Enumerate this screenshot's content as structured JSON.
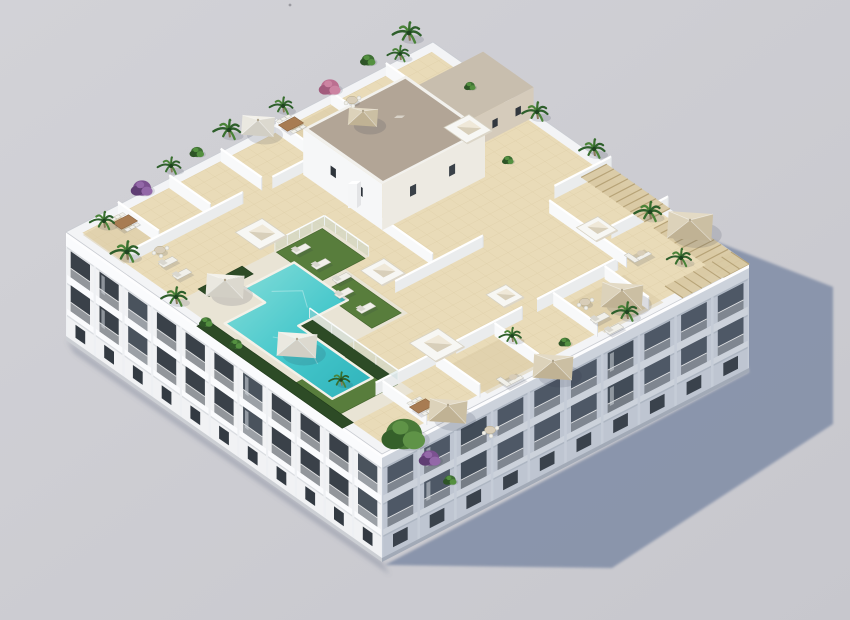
{
  "scene": {
    "description": "Aerial 3D architectural render of a white apartment block with a landscaped rooftop: communal turquoise pool, lawns, private tiled terraces with tan umbrellas, skylight boxes, stair core, pergolas and palm planting; long cast shadow on gray ground to the lower right",
    "canvas": {
      "width": 850,
      "height": 620
    },
    "palette": {
      "bg": "#c7c7cd",
      "bg_light": "#d2d2d7",
      "ground_shadow": "#8591a9",
      "shadow_soft": "rgba(90,100,125,0.30)",
      "obj_shadow": "rgba(40,50,70,0.14)",
      "facade_lit": "#f1f2f4",
      "facade_lit_band": "#fafbfd",
      "facade_pier_lit": "#eef0f3",
      "window_dark": "#3a4149",
      "window_dark2": "#4a535d",
      "window_small": "#333a42",
      "facade_shaded": "#bec5d1",
      "facade_shaded_band": "#ccd2db",
      "facade_pier_shaded": "#c5ccd7",
      "window_shaded": "#4e5866",
      "window_shaded2": "#424c58",
      "window_small_shaded": "#3a424c",
      "slab_shade": "rgba(60,70,90,0.12)",
      "plinth": "rgba(40,50,65,0.18)",
      "coping": "#fdfdfe",
      "parapet": "#f3f4f6",
      "parapet_edge": "#c9ccd2",
      "tile": "#e9dbb8",
      "tile_line": "#d8c79e",
      "wall_lit": "#f8f9fa",
      "wall_shaded": "#eaeced",
      "wall_cap": "#ffffff",
      "wall_end": "#dfe2e5",
      "core_lit": "#f6f7f8",
      "core_shaded": "#edeae2",
      "core_roof": "#b2a596",
      "core_rim": "#f2f1ed",
      "annex_wall": "#d5cbbb",
      "annex_roof": "#c8beae",
      "deck": "#e9e4d5",
      "deck_edge": "#f4f1e8",
      "pool_light": "#8adfda",
      "pool": "#45c7cb",
      "pool_dark": "#2fb2ba",
      "grass": "#587d3c",
      "grass_dark": "#46662f",
      "hedge": "#2d4b26",
      "hedge_dark": "#1f3a1a",
      "pergola": "#d9c9a3",
      "pergola_line": "#b39e72",
      "umb_tan": "#e3dac5",
      "umb_tan_dark": "#cbbfa3",
      "umb_tan_deep": "#c0b294",
      "umb_tan_mid": "#dcd2ba",
      "umb_white": "#f3f1ea",
      "umb_white_dark": "#dcd9cf",
      "umb_white_deep": "#d2cfc5",
      "umb_white_mid": "#eae8e0",
      "furn_white": "#f1f0ea",
      "furn_shade": "#d9d7cf",
      "furn_stroke": "#bdbcb4",
      "table_wood": "#a87c52",
      "table_wood_dark": "#8a6542",
      "table_top": "#d8cdb8",
      "glass": "#bcd6d8",
      "glass_rail": "#fbfdfd",
      "palm1": "#2e5f2b",
      "palm2": "#4a8338",
      "palm3": "#386f2e",
      "palm_core": "#1f4420",
      "trunk": "#8a7a5c",
      "bush1": "#3f7034",
      "bush2": "#2e5527",
      "bush3": "#549040",
      "tree1": "#4a7a38",
      "tree2": "#35602a",
      "tree3": "#5f9347",
      "purple1": "#7c5190",
      "purple2": "#9368a8",
      "purple3": "#5f3d73",
      "pink1": "#bb6f90",
      "pink2": "#cc84a2",
      "pink3": "#a25c7d",
      "speck": "#9a9aa0"
    },
    "building": {
      "roof_corners": {
        "west": [
          66,
          232
        ],
        "north": [
          433,
          42
        ],
        "east": [
          749,
          264
        ],
        "south": [
          382,
          454
        ]
      },
      "height_px": 108,
      "core": {
        "u0": 0.5,
        "u1": 0.78,
        "v0": 0.17,
        "v1": 0.42,
        "h": 46
      },
      "annex": {
        "u0": 0.78,
        "u1": 0.99,
        "v0": 0.17,
        "v1": 0.33,
        "h": 30
      },
      "chimney": {
        "x": 352,
        "y": 208
      }
    },
    "shadow": {
      "polygon": [
        [
          712,
          240
        ],
        [
          833,
          287
        ],
        [
          833,
          424
        ],
        [
          612,
          568
        ],
        [
          385,
          565
        ],
        [
          749,
          372
        ]
      ]
    },
    "facades": {
      "sw": {
        "bays": 11,
        "floor_ys": [
          16,
          50
        ],
        "floor_h": 26,
        "ground_y": 86,
        "ground_h": 13
      },
      "se": {
        "bays": 10,
        "floor_ys": [
          16,
          50
        ],
        "floor_h": 26,
        "ground_y": 86,
        "ground_h": 13
      }
    },
    "roof": {
      "parapet_inset": 0.024,
      "pool_uv": [
        [
          0.155,
          0.385
        ],
        [
          0.29,
          0.385
        ],
        [
          0.29,
          0.555
        ],
        [
          0.155,
          0.555
        ],
        [
          0.155,
          0.79
        ],
        [
          0.045,
          0.79
        ],
        [
          0.045,
          0.45
        ],
        [
          0.155,
          0.45
        ]
      ],
      "deck_uv": [
        [
          0.02,
          0.33
        ],
        [
          0.42,
          0.33
        ],
        [
          0.42,
          0.47
        ],
        [
          0.355,
          0.47
        ],
        [
          0.355,
          0.67
        ],
        [
          0.19,
          0.67
        ],
        [
          0.19,
          0.88
        ],
        [
          0.02,
          0.88
        ]
      ],
      "lawns_uv": [
        [
          [
            0.285,
            0.335
          ],
          [
            0.41,
            0.335
          ],
          [
            0.41,
            0.47
          ],
          [
            0.285,
            0.47
          ]
        ],
        [
          [
            0.265,
            0.5
          ],
          [
            0.345,
            0.5
          ],
          [
            0.345,
            0.66
          ],
          [
            0.265,
            0.66
          ]
        ],
        [
          [
            0.02,
            0.7
          ],
          [
            0.18,
            0.7
          ],
          [
            0.18,
            0.84
          ],
          [
            0.02,
            0.84
          ]
        ]
      ],
      "hedges_uv": [
        [
          [
            0.16,
            0.55
          ],
          [
            0.19,
            0.55
          ],
          [
            0.19,
            0.83
          ],
          [
            0.16,
            0.83
          ]
        ],
        [
          [
            -0.005,
            0.42
          ],
          [
            0.025,
            0.42
          ],
          [
            0.025,
            0.88
          ],
          [
            -0.005,
            0.88
          ]
        ],
        [
          [
            0.08,
            0.325
          ],
          [
            0.2,
            0.325
          ],
          [
            0.2,
            0.36
          ],
          [
            0.08,
            0.36
          ]
        ]
      ],
      "wood_uv": [
        [
          [
            0.62,
            0.86
          ],
          [
            0.78,
            0.86
          ],
          [
            0.78,
            0.985
          ],
          [
            0.62,
            0.985
          ]
        ],
        [
          [
            0.3,
            0.86
          ],
          [
            0.46,
            0.86
          ],
          [
            0.46,
            0.985
          ],
          [
            0.3,
            0.985
          ]
        ],
        [
          [
            0.55,
            0.03
          ],
          [
            0.7,
            0.03
          ],
          [
            0.7,
            0.15
          ],
          [
            0.55,
            0.15
          ]
        ],
        [
          [
            0.02,
            0.03
          ],
          [
            0.13,
            0.03
          ],
          [
            0.13,
            0.16
          ],
          [
            0.02,
            0.16
          ]
        ]
      ],
      "walls": [
        {
          "d": "v",
          "u": 0.12,
          "a": 0.025,
          "b": 0.155,
          "h": 13
        },
        {
          "d": "v",
          "u": 0.26,
          "a": 0.025,
          "b": 0.155,
          "h": 13
        },
        {
          "d": "v",
          "u": 0.4,
          "a": 0.025,
          "b": 0.155,
          "h": 13
        },
        {
          "d": "v",
          "u": 0.55,
          "a": 0.025,
          "b": 0.155,
          "h": 13
        },
        {
          "d": "v",
          "u": 0.7,
          "a": 0.025,
          "b": 0.155,
          "h": 13
        },
        {
          "d": "v",
          "u": 0.85,
          "a": 0.025,
          "b": 0.155,
          "h": 13
        },
        {
          "d": "u",
          "v": 0.165,
          "a": 0.03,
          "b": 0.34,
          "h": 12
        },
        {
          "d": "u",
          "v": 0.165,
          "a": 0.42,
          "b": 0.52,
          "h": 12
        },
        {
          "d": "v",
          "u": 0.5,
          "a": 0.42,
          "b": 0.58,
          "h": 12
        },
        {
          "d": "u",
          "v": 0.6,
          "a": 0.38,
          "b": 0.62,
          "h": 12
        },
        {
          "d": "u",
          "v": 0.84,
          "a": 0.12,
          "b": 0.3,
          "h": 13
        },
        {
          "d": "u",
          "v": 0.84,
          "a": 0.34,
          "b": 0.52,
          "h": 13
        },
        {
          "d": "u",
          "v": 0.84,
          "a": 0.56,
          "b": 0.78,
          "h": 13
        },
        {
          "d": "v",
          "u": 0.135,
          "a": 0.845,
          "b": 0.985,
          "h": 13
        },
        {
          "d": "v",
          "u": 0.28,
          "a": 0.845,
          "b": 0.985,
          "h": 13
        },
        {
          "d": "v",
          "u": 0.44,
          "a": 0.845,
          "b": 0.985,
          "h": 13
        },
        {
          "d": "v",
          "u": 0.6,
          "a": 0.845,
          "b": 0.985,
          "h": 13
        },
        {
          "d": "v",
          "u": 0.74,
          "a": 0.845,
          "b": 0.985,
          "h": 13
        },
        {
          "d": "v",
          "u": 0.8,
          "a": 0.6,
          "b": 0.845,
          "h": 13
        },
        {
          "d": "u",
          "v": 0.57,
          "a": 0.84,
          "b": 0.995,
          "h": 13
        },
        {
          "d": "u",
          "v": 0.75,
          "a": 0.84,
          "b": 0.995,
          "h": 13
        }
      ],
      "glass": [
        {
          "d": "v",
          "u": 0.42,
          "a": 0.33,
          "b": 0.47,
          "h": 10
        },
        {
          "d": "u",
          "v": 0.33,
          "a": 0.285,
          "b": 0.42,
          "h": 10
        },
        {
          "d": "v",
          "u": 0.19,
          "a": 0.55,
          "b": 0.83,
          "h": 10
        }
      ],
      "pergolas_uv": [
        [
          [
            0.93,
            0.55
          ],
          [
            1.0,
            0.55
          ],
          [
            1.0,
            0.75
          ],
          [
            0.93,
            0.75
          ]
        ],
        [
          [
            0.93,
            0.78
          ],
          [
            1.0,
            0.78
          ],
          [
            1.0,
            1.0
          ],
          [
            0.93,
            1.0
          ]
        ]
      ],
      "pergola_corner": [
        [
          749,
          264
        ],
        [
          683,
          298
        ],
        [
          665,
          286
        ],
        [
          731,
          252
        ]
      ],
      "skylights": [
        [
          261,
          234,
          15
        ],
        [
          383,
          272,
          13
        ],
        [
          437,
          345,
          16
        ],
        [
          468,
          129,
          14
        ],
        [
          597,
          229,
          12
        ],
        [
          505,
          296,
          11
        ]
      ],
      "umbrellas": [
        [
          258,
          126,
          19,
          "white"
        ],
        [
          363,
          117,
          17,
          "tan"
        ],
        [
          690,
          226,
          26,
          "tan"
        ],
        [
          622,
          296,
          24,
          "tan"
        ],
        [
          553,
          367,
          23,
          "tan"
        ],
        [
          448,
          411,
          22,
          "tan"
        ],
        [
          225,
          286,
          22,
          "white"
        ],
        [
          297,
          345,
          23,
          "white"
        ]
      ],
      "loungers": [
        [
          301,
          249
        ],
        [
          321,
          264
        ],
        [
          342,
          278
        ],
        [
          344,
          293
        ],
        [
          366,
          308
        ],
        [
          168,
          262
        ],
        [
          182,
          274
        ],
        [
          600,
          318
        ],
        [
          614,
          329
        ]
      ],
      "furniture": [
        [
          291,
          124,
          "wood"
        ],
        [
          125,
          222,
          "wood"
        ],
        [
          422,
          406,
          "wood"
        ],
        [
          638,
          254,
          "sofa"
        ],
        [
          510,
          378,
          "sofa"
        ],
        [
          585,
          302,
          "round"
        ],
        [
          352,
          100,
          "round"
        ],
        [
          160,
          250,
          "round"
        ],
        [
          490,
          430,
          "round"
        ]
      ],
      "plants": [
        [
          "palm",
          409,
          33,
          1.1
        ],
        [
          "bush",
          368,
          60,
          0.8
        ],
        [
          "pink",
          330,
          87,
          1.0
        ],
        [
          "palm",
          283,
          106,
          0.9
        ],
        [
          "palm",
          229,
          130,
          1.05
        ],
        [
          "bush",
          197,
          152,
          0.75
        ],
        [
          "palm",
          171,
          166,
          0.9
        ],
        [
          "purple",
          142,
          188,
          1.0
        ],
        [
          "palm",
          104,
          221,
          0.95
        ],
        [
          "palm",
          127,
          252,
          1.1
        ],
        [
          "palm",
          176,
          297,
          1.0
        ],
        [
          "bush",
          206,
          322,
          0.7
        ],
        [
          "palm",
          400,
          54,
          0.85
        ],
        [
          "bush",
          470,
          86,
          0.6
        ],
        [
          "palm",
          537,
          112,
          1.0
        ],
        [
          "bush",
          508,
          160,
          0.6
        ],
        [
          "palm",
          594,
          149,
          1.0
        ],
        [
          "palm",
          650,
          212,
          1.05
        ],
        [
          "palm",
          681,
          258,
          0.95
        ],
        [
          "palm",
          627,
          312,
          1.0
        ],
        [
          "bush",
          565,
          342,
          0.65
        ],
        [
          "palm",
          512,
          336,
          0.85
        ],
        [
          "tree",
          404,
          434,
          1.25
        ],
        [
          "purple",
          430,
          458,
          1.0
        ],
        [
          "bush",
          450,
          480,
          0.7
        ],
        [
          "palm",
          341,
          380,
          0.8
        ],
        [
          "bush",
          236,
          344,
          0.7
        ]
      ]
    },
    "speck": [
      290,
      5
    ]
  }
}
